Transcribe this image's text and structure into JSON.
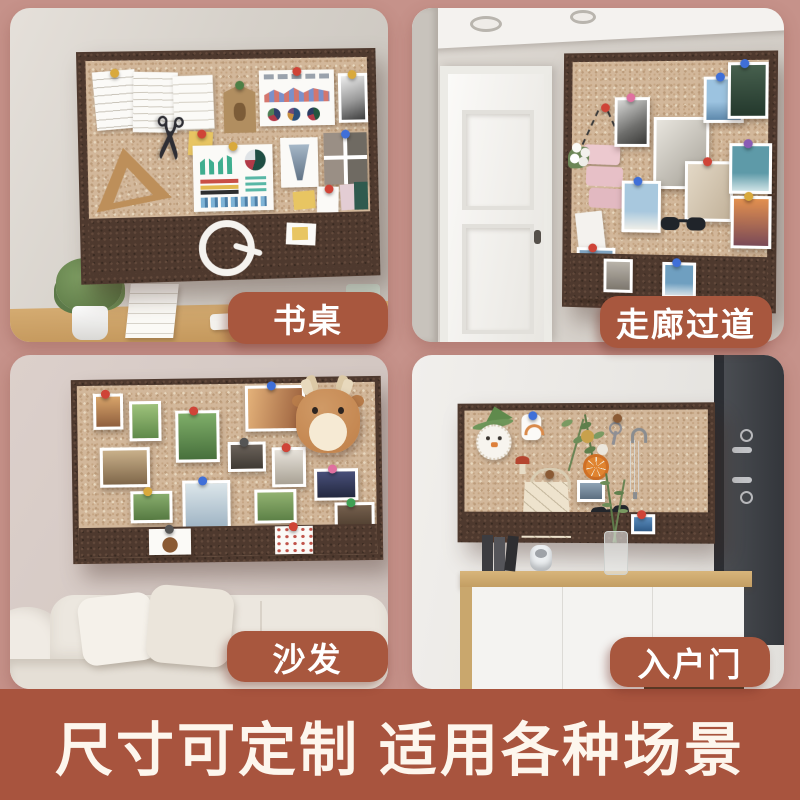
{
  "poster": {
    "background_color": "#c6928a",
    "scenes": [
      {
        "id": "desk",
        "label": "书桌"
      },
      {
        "id": "hallway",
        "label": "走廊过道"
      },
      {
        "id": "sofa",
        "label": "沙发"
      },
      {
        "id": "entrance",
        "label": "入户门"
      }
    ],
    "scene_tag_style": {
      "background_color": "#a8573e",
      "text_color": "#ffffff"
    },
    "banner": {
      "text": "尺寸可定制 适用各种场景",
      "background_color": "#a8543e",
      "text_color": "#fdf6ed"
    },
    "board_colors": {
      "cork": "#d2b79a",
      "felt": "#4e392e"
    },
    "icons": {
      "scissors": "✂"
    }
  }
}
